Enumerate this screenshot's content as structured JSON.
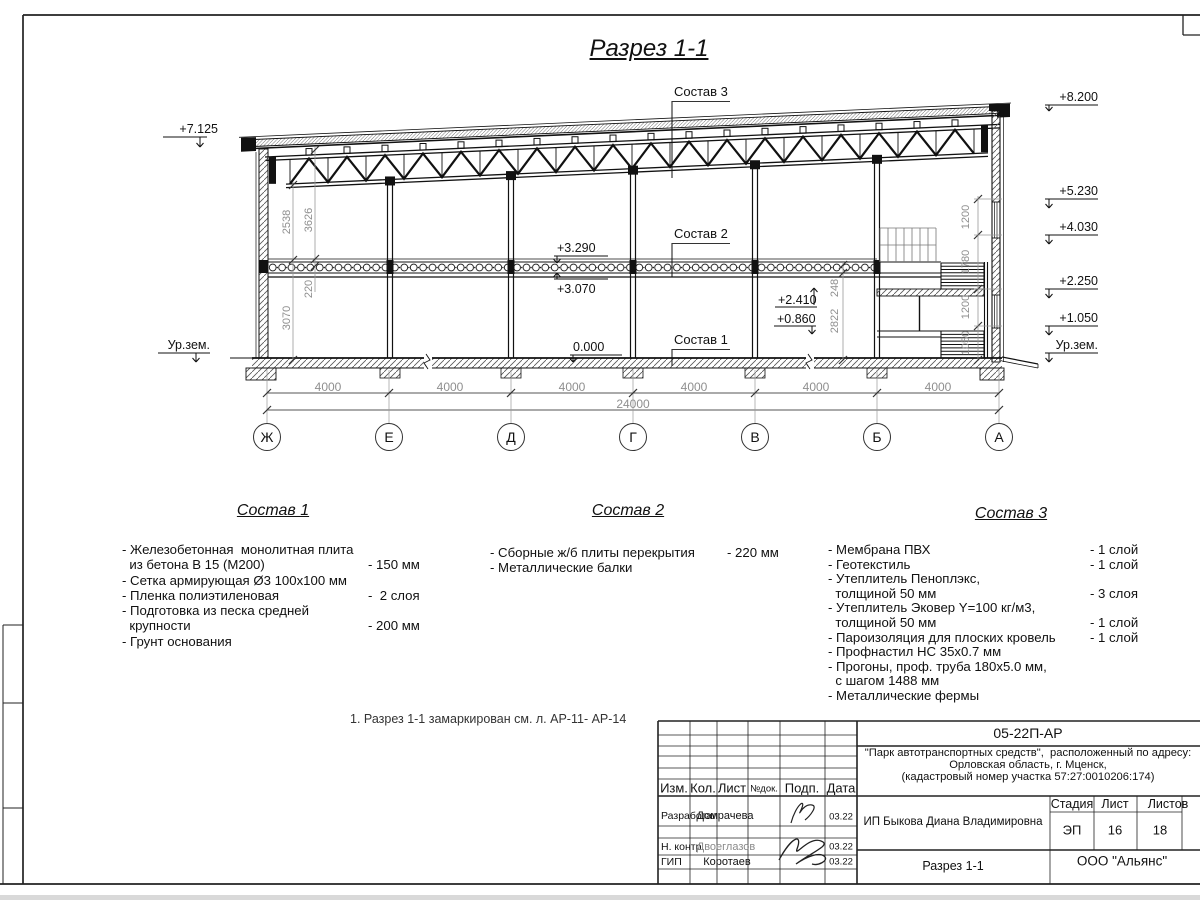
{
  "page": {
    "title": "Разрез 1-1",
    "note": "1. Разрез 1-1 замаркирован см. л. АР-11- АР-14"
  },
  "drawing": {
    "axes": [
      "Ж",
      "Е",
      "Д",
      "Г",
      "В",
      "Б",
      "А"
    ],
    "span_dim": "4000",
    "total_dim": "24000",
    "elev_left_top": "+7.125",
    "elev_ground_left": "Ур.зем.",
    "elev_ground_right": "Ур.зем.",
    "elev_right": [
      "+8.200",
      "+5.230",
      "+4.030",
      "+2.250",
      "+1.050"
    ],
    "elev_slab_top": "+3.290",
    "elev_slab_bottom": "+3.070",
    "elev_floor": "0.000",
    "elev_stair_upper": "+2.410",
    "elev_stair_lower": "+0.860",
    "vdim_left": [
      "2538",
      "3626",
      "220",
      "3070"
    ],
    "vdim_mid": [
      "248",
      "2822"
    ],
    "vdim_right": [
      "1200",
      "1780",
      "1200",
      "1050"
    ],
    "label_s1": "Состав 1",
    "label_s2": "Состав 2",
    "label_s3": "Состав 3"
  },
  "lists": {
    "s1": {
      "title": "Состав 1",
      "rows": [
        {
          "t": "- Железобетонная  монолитная плита",
          "v": ""
        },
        {
          "t": "  из бетона В 15 (М200)",
          "v": "- 150 мм"
        },
        {
          "t": "- Сетка армирующая Ø3 100х100 мм",
          "v": ""
        },
        {
          "t": "- Пленка полиэтиленовая",
          "v": "-  2 слоя"
        },
        {
          "t": "- Подготовка из песка средней",
          "v": ""
        },
        {
          "t": "  крупности",
          "v": "- 200 мм"
        },
        {
          "t": "- Грунт основания",
          "v": ""
        }
      ]
    },
    "s2": {
      "title": "Состав 2",
      "rows": [
        {
          "t": "- Сборные ж/б плиты перекрытия",
          "v": "- 220 мм"
        },
        {
          "t": "- Металлические балки",
          "v": ""
        }
      ]
    },
    "s3": {
      "title": "Состав 3",
      "rows": [
        {
          "t": "- Мембрана ПВХ",
          "v": "- 1 слой"
        },
        {
          "t": "- Геотекстиль",
          "v": "- 1 слой"
        },
        {
          "t": "- Утеплитель Пеноплэкс,",
          "v": ""
        },
        {
          "t": "  толщиной 50 мм",
          "v": "- 3 слоя"
        },
        {
          "t": "- Утеплитель Эковер Y=100 кг/м3,",
          "v": ""
        },
        {
          "t": "  толщиной 50 мм",
          "v": "- 1 слой"
        },
        {
          "t": "- Пароизоляция для плоских кровель",
          "v": "- 1 слой"
        },
        {
          "t": "- Профнастил НС 35х0.7 мм",
          "v": ""
        },
        {
          "t": "- Прогоны, проф. труба 180х5.0 мм,",
          "v": ""
        },
        {
          "t": "  с шагом 1488 мм",
          "v": ""
        },
        {
          "t": "- Металлические фермы",
          "v": ""
        }
      ]
    }
  },
  "titleblock": {
    "doc_number": "05-22П-АР",
    "project_line1": "\"Парк автотранспортных средств\",  расположенный по адресу:",
    "project_line2": "Орловская область, г. Мценск,",
    "project_line3": "(кадастровый номер участка 57:27:0010206:174)",
    "client": "ИП Быкова Диана Владимировна",
    "sheet_title": "Разрез 1-1",
    "company": "ООО \"Альянс\"",
    "col_izm": "Изм.",
    "col_kol": "Кол.",
    "col_list": "Лист",
    "col_ndok": "№док.",
    "col_podp": "Подп.",
    "col_data": "Дата",
    "stage_label": "Стадия",
    "sheet_label": "Лист",
    "sheets_label": "Листов",
    "stage": "ЭП",
    "sheet_no": "16",
    "sheets_total": "18",
    "rows": [
      {
        "role": "Разработал",
        "name": "Домрачева",
        "date": "03.22"
      },
      {
        "role": "Н. контр.",
        "name": "Двоеглазов",
        "date": "03.22"
      },
      {
        "role": "ГИП",
        "name": "Коротаев",
        "date": "03.22"
      }
    ]
  }
}
